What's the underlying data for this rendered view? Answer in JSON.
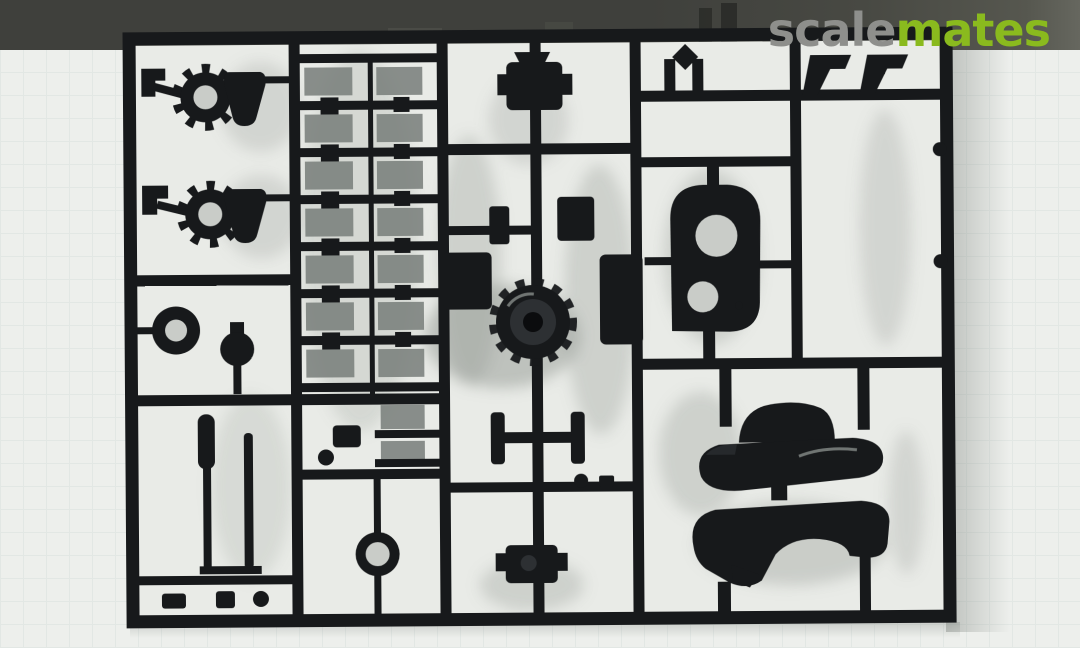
{
  "watermark": {
    "prefix": "scale",
    "suffix": "mates"
  },
  "scene": {
    "subject": "Injection-molded black plastic model kit sprue (parts tree)",
    "setting": "photographed on a pale cutting mat with a dark backdrop strip along the top edge",
    "notable_parts": "cog-ring wheels, bell cones, ladder of suspension units, central drive hub, axle, arched gearbox housing with two round openings, two large hull fender halves, long barrel rods, ring collar"
  },
  "colors": {
    "band": "#3f403c",
    "mat": "#edefec",
    "matgrid": "#e2e7e4",
    "cell": "#e9ebe7",
    "plastic": "#17191b",
    "plastichi": "#2d3033",
    "hole": "#c9ccc8",
    "shadow": "#8f958f",
    "wmgray": "#8e8f8c",
    "wmgreen": "#8aba1e"
  }
}
